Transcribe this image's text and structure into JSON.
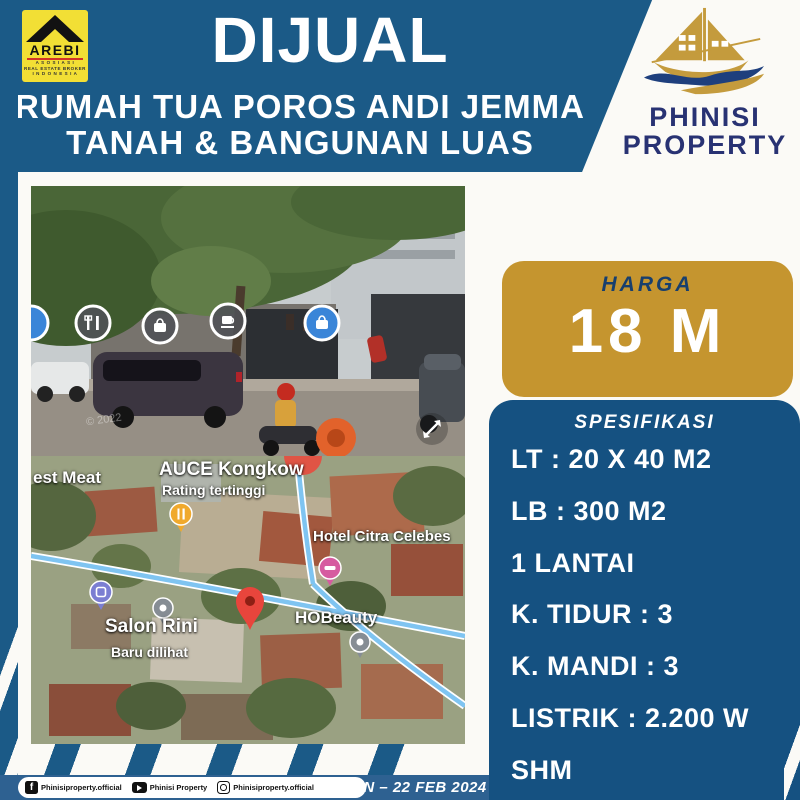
{
  "header": {
    "title": "DIJUAL",
    "subtitle1": "RUMAH TUA POROS ANDI JEMMA",
    "subtitle2": "TANAH & BANGUNAN LUAS"
  },
  "arebi": {
    "name": "AREBI",
    "sub1": "A S O S I A S I",
    "sub2": "REAL ESTATE BROKER",
    "sub3": "I N D O N E S I A"
  },
  "brand": {
    "line1": "PHINISI",
    "line2": "PROPERTY"
  },
  "price": {
    "label": "HARGA",
    "value": "18 M"
  },
  "specs": {
    "header": "SPESIFIKASI",
    "items": [
      "LT : 20 X 40 M2",
      "LB : 300 M2",
      "1 LANTAI",
      "K. TIDUR : 3",
      "K. MANDI : 3",
      "LISTRIK : 2.200 W",
      "SHM"
    ]
  },
  "photo": {
    "watermark": "© 2022"
  },
  "map": {
    "labels": {
      "estmeat": "est Meat",
      "auce": "AUCE Kongkow",
      "rating": "Rating tertinggi",
      "hotel": "Hotel Citra Celebes",
      "hobeauty": "HOBeauty",
      "salon": "Salon Rini",
      "baru": "Baru dilihat"
    }
  },
  "footer": {
    "facebook": "Phinisiproperty.official",
    "youtube": "Phinisi Property",
    "instagram": "Phinisiproperty.official",
    "date": "AN – 22 FEB 2024"
  },
  "colors": {
    "navy": "#1b5a87",
    "navy_dark": "#155181",
    "footer_blue": "#2e6191",
    "gold": "#c5952f",
    "arebi_yellow": "#f2df35",
    "brand_navy": "#283273",
    "map_road_blue": "#7fc4f1",
    "pin_red": "#e8453c"
  }
}
